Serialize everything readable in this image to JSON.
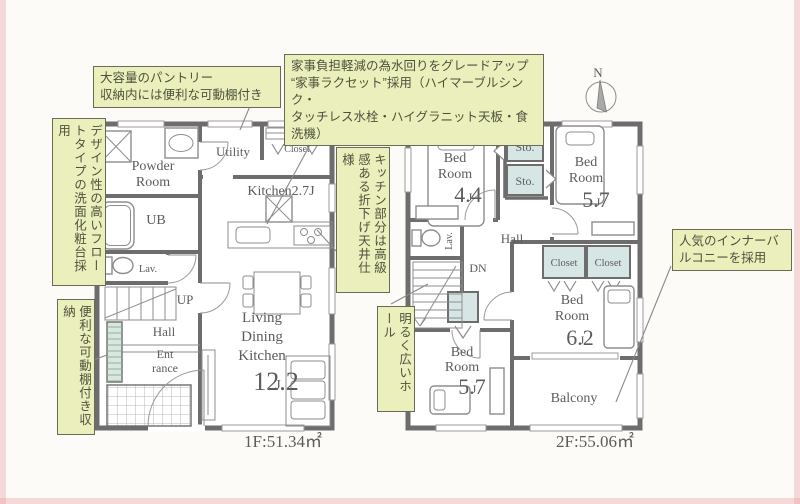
{
  "ann": {
    "kitchen_upgrade": "家事負担軽減の為水回りをグレードアップ\n“家事ラクセット”採用（ハイマーブルシンク・\nタッチレス水栓・ハイグラニット天板・食洗機）",
    "pantry": "大容量のパントリー\n収納内には便利な可動棚付き",
    "vanity": "デザイン性の高いフロートタイプの洗面化粧台採用",
    "storage": "便利な可動棚付き収納",
    "ceiling": "キッチン部分は高級感ある折下げ天井仕様",
    "hall": "明るく広いホール",
    "balcony": "人気のインナーバルコニーを採用"
  },
  "f1": {
    "area": "1F:51.34㎡",
    "powder1": "Powder",
    "powder2": "Room",
    "utility": "Utility",
    "closet": "Closet",
    "kitchen": "Kitchen2.7J",
    "ub": "UB",
    "lav": "Lav.",
    "up": "UP",
    "hall": "Hall",
    "ent1": "Ent",
    "ent2": "rance",
    "ldk1": "Living",
    "ldk2": "Dining",
    "ldk3": "Kitchen",
    "ldk_num": "12.2",
    "ldk_unit": "J"
  },
  "f2": {
    "area": "2F:55.06㎡",
    "bed1a": "Bed",
    "bed1b": "Room",
    "bed1n": "4.4",
    "bed1u": "J",
    "sto1": "Sto.",
    "sto2": "Sto.",
    "sto3": "Sto.",
    "bed2a": "Bed",
    "bed2b": "Room",
    "bed2n": "5.7",
    "bed2u": "J",
    "hall": "Hall",
    "lav": "Lav.",
    "dn": "DN",
    "closet1": "Closet",
    "closet2": "Closet",
    "bed3a": "Bed",
    "bed3b": "Room",
    "bed3n": "6.2",
    "bed3u": "J",
    "bed4a": "Bed",
    "bed4b": "Room",
    "bed4n": "5.7",
    "bed4u": "J",
    "balcony": "Balcony"
  },
  "compass": {
    "n": "N"
  },
  "colors": {
    "highlight": "#eaefbb",
    "wall": "#6d6d6d",
    "storage_fill": "#d5e6e4",
    "paper": "#fcfbf7"
  }
}
